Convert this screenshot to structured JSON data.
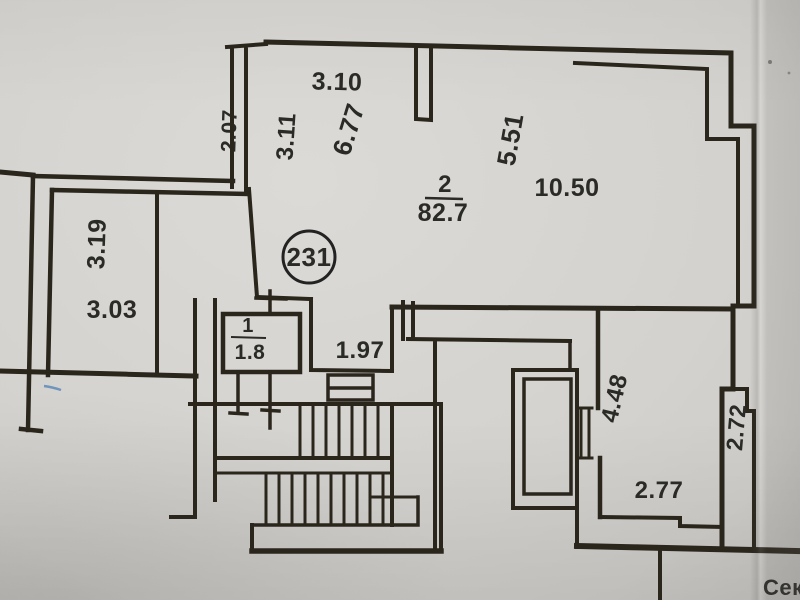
{
  "floor_plan": {
    "apartment_badge": "231",
    "rooms": [
      {
        "number": "2",
        "area": "82.7"
      },
      {
        "number": "1",
        "area": "1.8"
      }
    ],
    "dimensions": {
      "top_width": "3.10",
      "corridor_width": "3.11",
      "corridor_length": "6.77",
      "room2_depth": "5.51",
      "room2_width": "10.50",
      "left_room_depth": "3.19",
      "left_room_width": "3.03",
      "hall_width": "1.97",
      "service_depth": "4.48",
      "right_strip_depth": "2.72",
      "service_width": "2.77",
      "partial_left": "2.07"
    },
    "corner_text": "Сек"
  }
}
